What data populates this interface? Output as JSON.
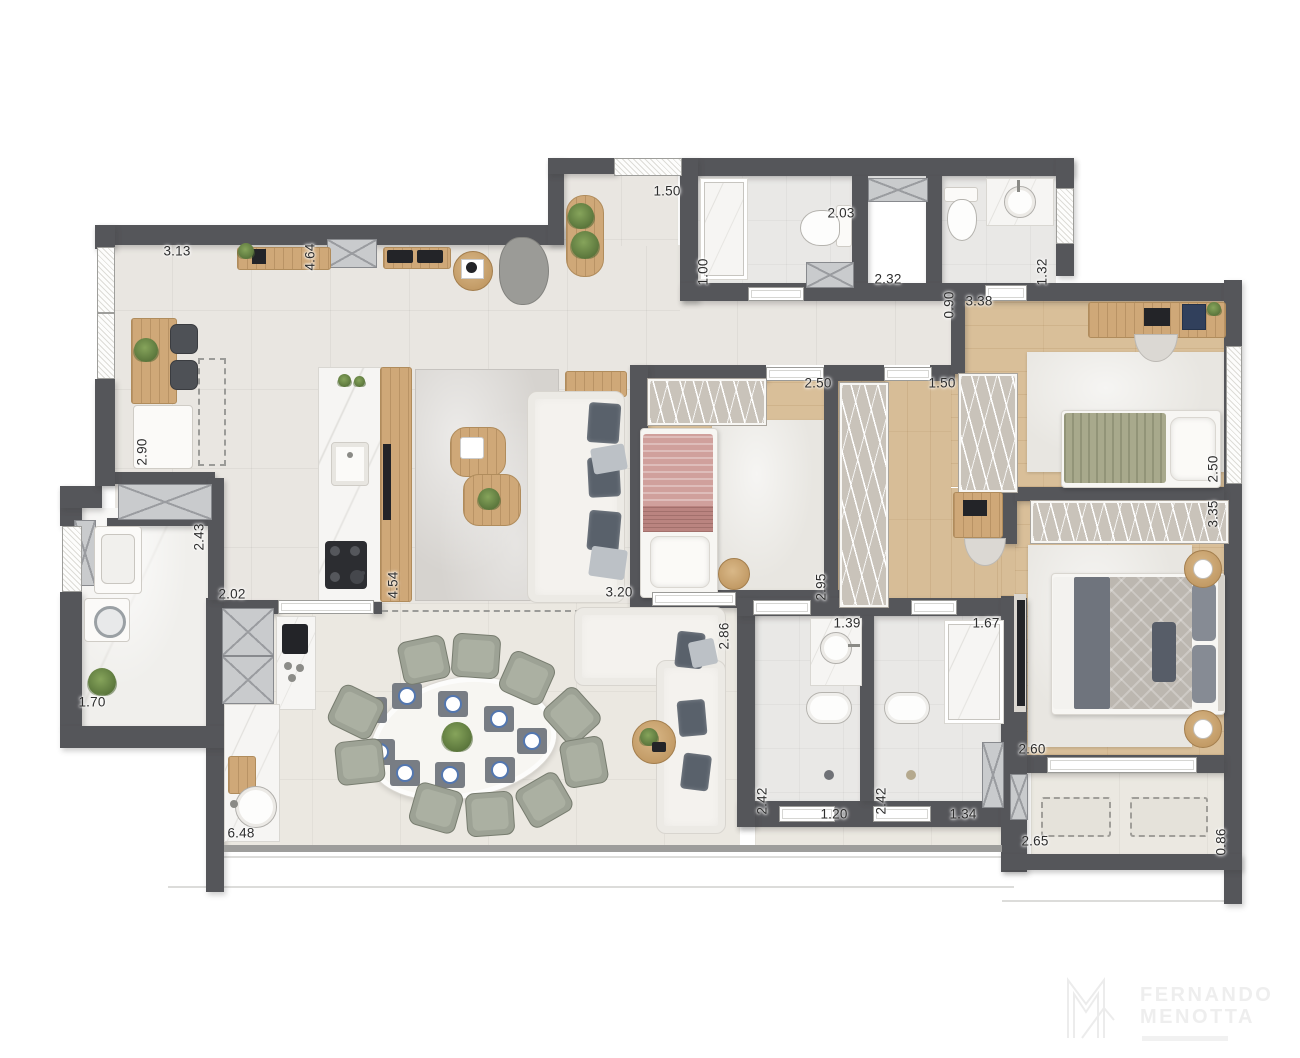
{
  "dimensions": {
    "d01": "3.13",
    "d02": "4.64",
    "d03": "1.50",
    "d04": "2.03",
    "d05": "1.00",
    "d06": "2.32",
    "d07": "0.90",
    "d08": "3.38",
    "d09": "1.32",
    "d10": "2.50",
    "d11": "3.35",
    "d12": "2.50",
    "d13": "1.50",
    "d14": "2.90",
    "d15": "2.43",
    "d16": "2.02",
    "d17": "4.54",
    "d18": "3.20",
    "d19": "2.95",
    "d20": "2.86",
    "d21": "1.39",
    "d22": "1.67",
    "d23": "2.42",
    "d24": "1.20",
    "d25": "2.42",
    "d26": "1.34",
    "d27": "2.60",
    "d28": "1.70",
    "d29": "6.48",
    "d30": "2.65",
    "d31": "0.86"
  },
  "logo": {
    "line1": "FERNANDO",
    "line2": "MENOTTA"
  },
  "colors": {
    "wall": "#55565a",
    "wood_floor": "#d9bf99",
    "tile_floor": "#e9e6e1",
    "bath_floor": "#e9e8e6",
    "terrace_floor": "#ebe8e1",
    "living_rug": "#d6d3cf",
    "bed_pink": "#d0a09c",
    "bed_olive": "#a8a98c",
    "bed_gray_quilt": "#bcb7b0",
    "dining_chair": "#9da295",
    "marble": "#f6f5f3",
    "logo_gray": "#eeeeee"
  }
}
